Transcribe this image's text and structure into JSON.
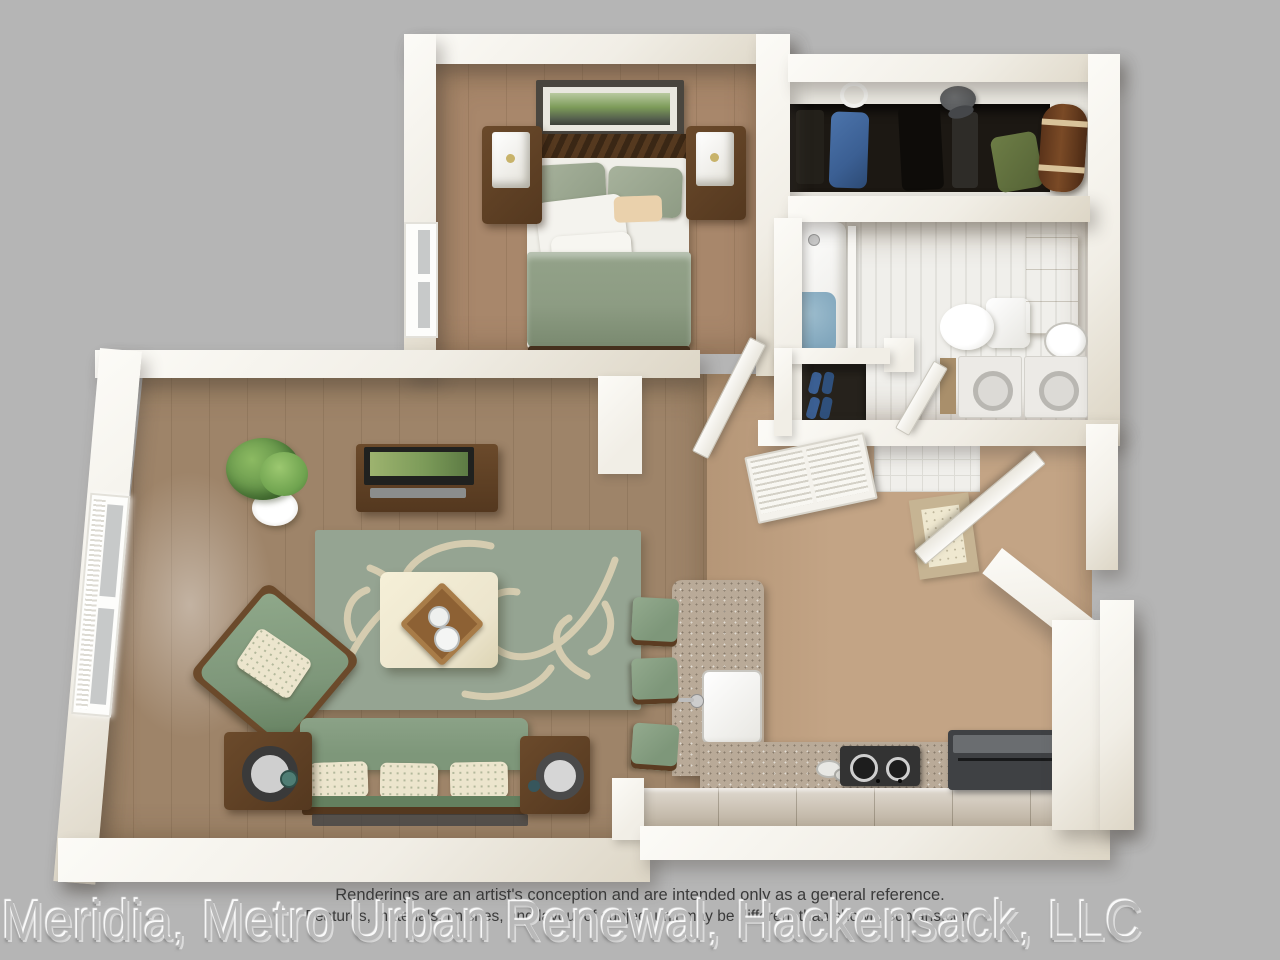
{
  "disclaimer": {
    "line1": "Renderings are an artist's conception and are intended only as a general reference.",
    "line2": "Features, materials, finishes, and layout of subject unit may be different than shown. 3dplans.com"
  },
  "watermark": {
    "text": "Meridia, Metro Urban Renewal, Hackensack, LLC"
  },
  "palette": {
    "bg": "#b5b5b5",
    "wall": "#f1eee6",
    "wall_shade": "#ddd6c6",
    "wall_bright": "#fcfbf7",
    "floor_bedroom": "#a8876b",
    "floor_living": "#9e8469",
    "floor_kitchen": "#c3a485",
    "rug": "#95a492",
    "rug_pattern": "#d9cfb2",
    "green": "#7e977a",
    "green_dark": "#64805f",
    "cream": "#ece5cd",
    "wood_dark": "#54381f",
    "wood_mid": "#6b4a2b",
    "wood_light": "#c9b899",
    "counter": "#b9aa98",
    "cabinet": "#cfc5b6",
    "appliance": "#3f4144",
    "tile": "#f0efeb",
    "tile_line": "#dddcd6",
    "water": "#82a7bd",
    "art_green": "#7c9b59",
    "denim": "#3b5f93",
    "closet_dark": "#1c1813",
    "mat": "#c6b493",
    "mat_inner": "#efe8d0",
    "glass": "#c7c9c9",
    "text": "#3a3a3a",
    "watermark": "#b9b9b9"
  }
}
